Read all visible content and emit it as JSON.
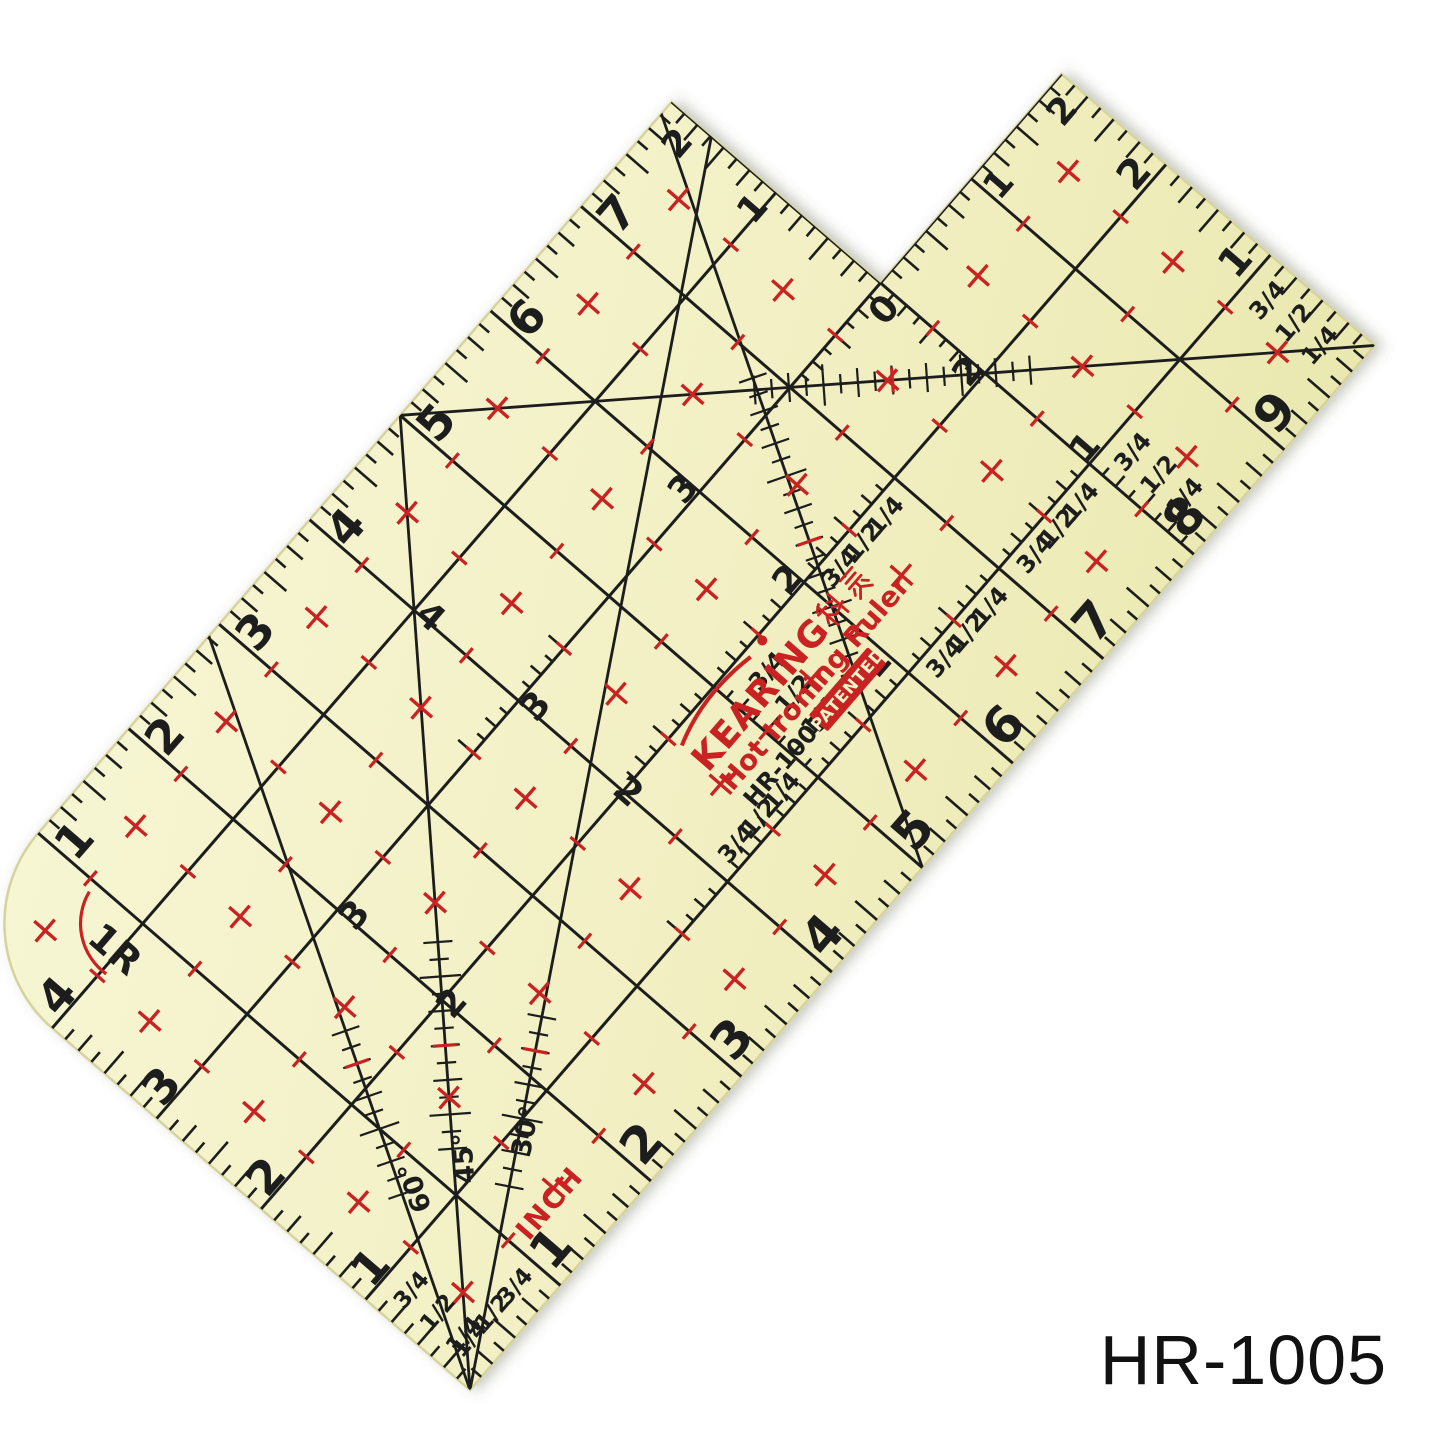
{
  "image": {
    "width": 1445,
    "height": 1445,
    "background": "#ffffff"
  },
  "caption": {
    "text": "HR-1005"
  },
  "branding": {
    "brand": "KEARING",
    "brand_cn": "科灵",
    "product": "Hot Ironing Ruler",
    "model": "HR-1005",
    "patented": "PATENTED"
  },
  "labels": {
    "unit": "INCH",
    "radius": "1R",
    "bottom_numbers": [
      "1",
      "2",
      "3",
      "4",
      "5",
      "6",
      "7",
      "8",
      "9"
    ],
    "top_numbers": [
      "1",
      "2",
      "3",
      "4",
      "5",
      "6",
      "7"
    ],
    "left_numbers": [
      "1",
      "2",
      "3",
      "4"
    ],
    "fractions": [
      "1/4",
      "1/2",
      "3/4"
    ],
    "fractions_desc": [
      "3/4",
      "1/2",
      "1/4"
    ],
    "right_ints": [
      "1",
      "2"
    ],
    "notch_v_ints": [
      "1",
      "2"
    ],
    "notch_h_ints": [
      "1",
      "2"
    ],
    "notch_zero": "0",
    "angles": [
      {
        "t": "60°",
        "x": 0.85,
        "y": 1.26,
        "rot": -60
      },
      {
        "t": "45°",
        "x": 1.24,
        "y": 1.13,
        "rot": -45
      },
      {
        "t": "30°",
        "x": 1.68,
        "y": 0.92,
        "rot": -30
      }
    ],
    "interior": [
      {
        "t": "1",
        "x": 5.9,
        "y": 1.22
      },
      {
        "t": "2",
        "x": 2.03,
        "y": 1.93
      },
      {
        "t": "2",
        "x": 5.94,
        "y": 2.1
      },
      {
        "t": "2",
        "x": 7.93,
        "y": 2.1
      },
      {
        "t": "2",
        "x": 4.02,
        "y": 1.97,
        "rot": 90
      },
      {
        "t": "3",
        "x": 2.05,
        "y": 2.88
      },
      {
        "t": "3",
        "x": 4.05,
        "y": 2.88
      },
      {
        "t": "3",
        "x": 5.94,
        "y": 3.1
      },
      {
        "t": "4",
        "x": 4.04,
        "y": 3.88,
        "rot": 90
      },
      {
        "t": "1",
        "x": 8.07,
        "y": 1.1
      }
    ]
  },
  "colors": {
    "body": "#f2f0c3",
    "body_hi": "#f7f6d4",
    "body_lo": "#eae8b0",
    "edge": "#d5d39c",
    "ink": "#1d1d1d",
    "red": "#c92222",
    "patent_text": "#f3f1c6",
    "caption": "#111111"
  },
  "geometry": {
    "scale_px_per_in": 138.2,
    "rotation_deg": -49.1,
    "origin": {
      "x": -52.3,
      "y": 937.6
    },
    "length_in": 10,
    "width_in": 5,
    "notch_x": 8,
    "notch_y": 3,
    "corner_radius_in": 1
  }
}
